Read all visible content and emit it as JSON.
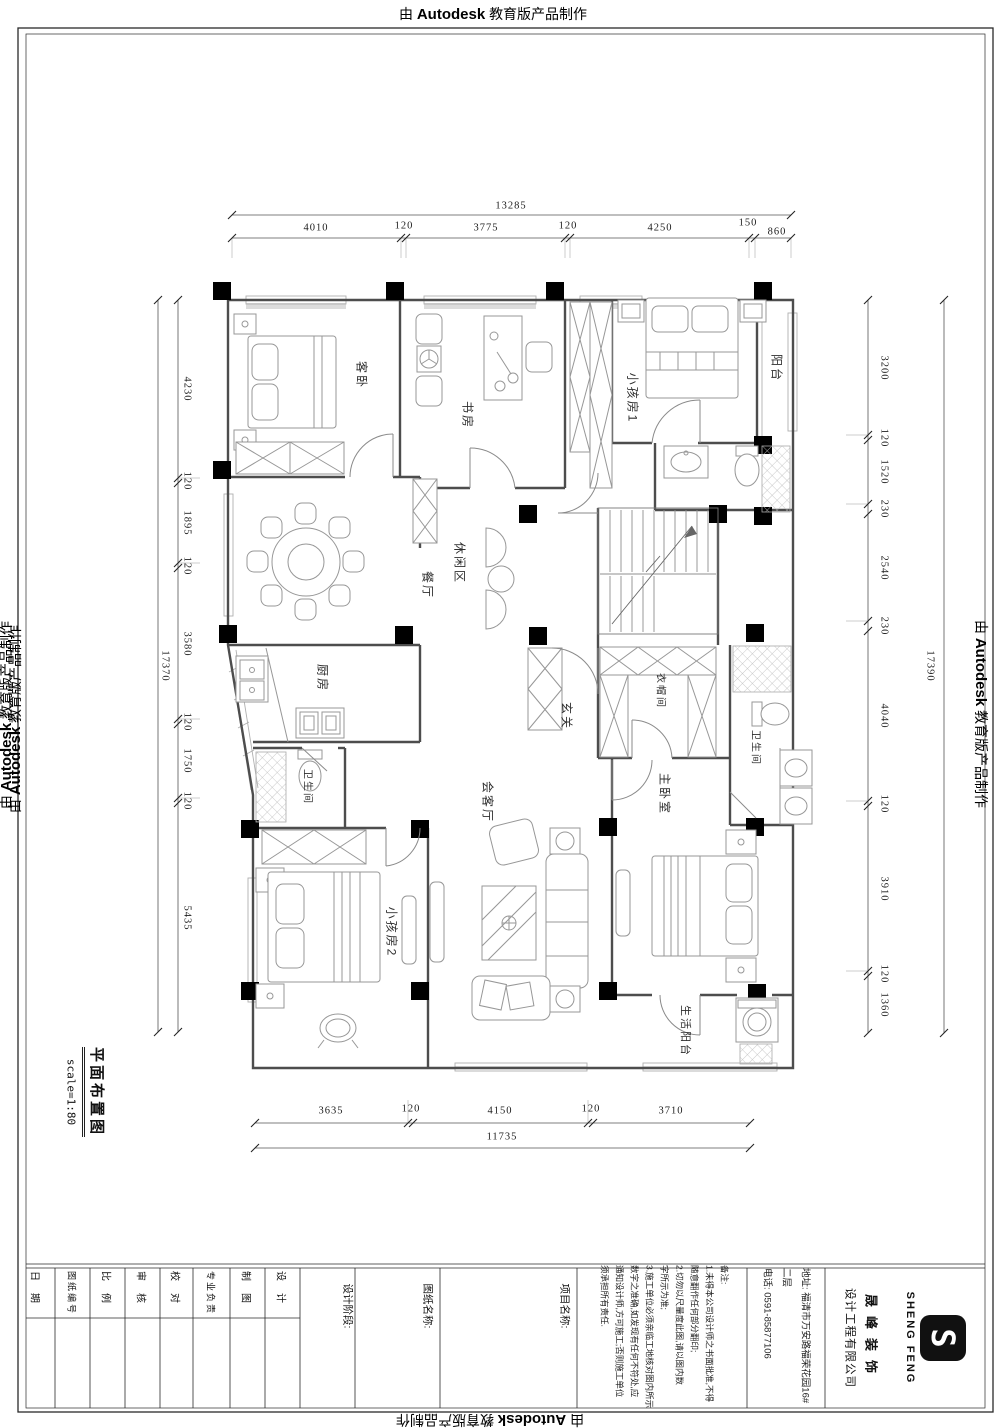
{
  "watermark": {
    "prefix": "由",
    "brand": "Autodesk",
    "suffix": "教育版产品制作"
  },
  "plan": {
    "title": "平面布置图",
    "scale": "scale=1:80",
    "rooms": {
      "guest": "客卧",
      "study": "书房",
      "kid1": "小孩房1",
      "balcony": "阳台",
      "dining": "餐厅",
      "leisure": "休闲区",
      "kitchen": "厨房",
      "bath_small": "卫生间",
      "foyer": "玄关",
      "cloak": "衣帽间",
      "bath_master": "卫生间",
      "living": "会客厅",
      "master": "主卧室",
      "kid2": "小孩房2",
      "service_balcony": "生活阳台"
    }
  },
  "dims": {
    "top": {
      "total": "13285",
      "segments": [
        "4010",
        "120",
        "3775",
        "120",
        "4250",
        "150",
        "860"
      ]
    },
    "left": {
      "total": "17370",
      "segments": [
        "4230",
        "120",
        "1895",
        "120",
        "3580",
        "120",
        "1750",
        "120",
        "5435"
      ]
    },
    "right": {
      "total": "17390",
      "segments": [
        "3200",
        "120",
        "1520",
        "230",
        "2540",
        "230",
        "4040",
        "120",
        "3910",
        "120",
        "1360"
      ]
    },
    "bottom": {
      "total": "11735",
      "segments": [
        "3635",
        "120",
        "4150",
        "120",
        "3710"
      ]
    }
  },
  "titleblock": {
    "fields": {
      "date": "日期",
      "drawing_no": "图纸编号",
      "ratio": "比例",
      "review": "审核",
      "proofread": "校对",
      "discipline": "专业负责",
      "draft": "制图",
      "design": "设计"
    },
    "design_stage": "设计阶段:",
    "drawing_name": "图纸名称:",
    "project_name": "项目名称:",
    "notes": [
      "备注:",
      "1.未得本公司设计师之书面批准,不得",
      "随意翻作任何部分翻印;",
      "2.切勿以尺量度此图,请以图内数",
      "字所示为准;",
      "3.施工单位必须亲临工地核对图内所示",
      "数字之准确,如发现有任何不符处,应",
      "通知设计师,方可施工;否则施工单位",
      "须承担所有责任."
    ],
    "address": "地址: 福清市万安路福荣花园16#二层",
    "phone": "电话: 0591-85877106",
    "company": {
      "name": "晟峰装饰",
      "sub": "设计工程有限公司",
      "logo_mark": "S",
      "logo_text": "SHENG FENG"
    }
  }
}
